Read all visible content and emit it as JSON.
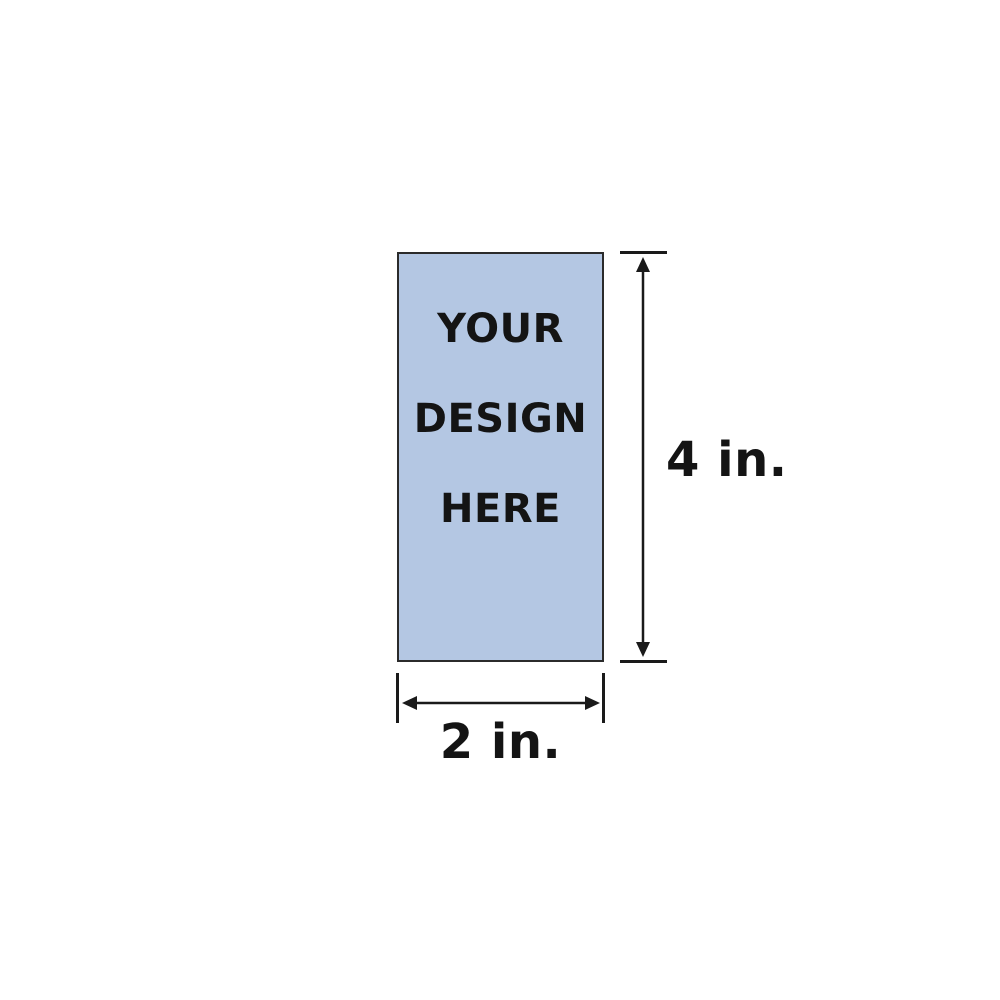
{
  "diagram": {
    "placeholder": {
      "line1": "YOUR",
      "line2": "DESIGN",
      "line3": "HERE"
    },
    "dimensions": {
      "height_label": "4 in.",
      "width_label": "2 in."
    },
    "colors": {
      "background": "#ffffff",
      "rect_fill": "#b4c7e3",
      "rect_border": "#2b2b2b",
      "dimension": "#1a1a1a",
      "text": "#141414"
    }
  }
}
